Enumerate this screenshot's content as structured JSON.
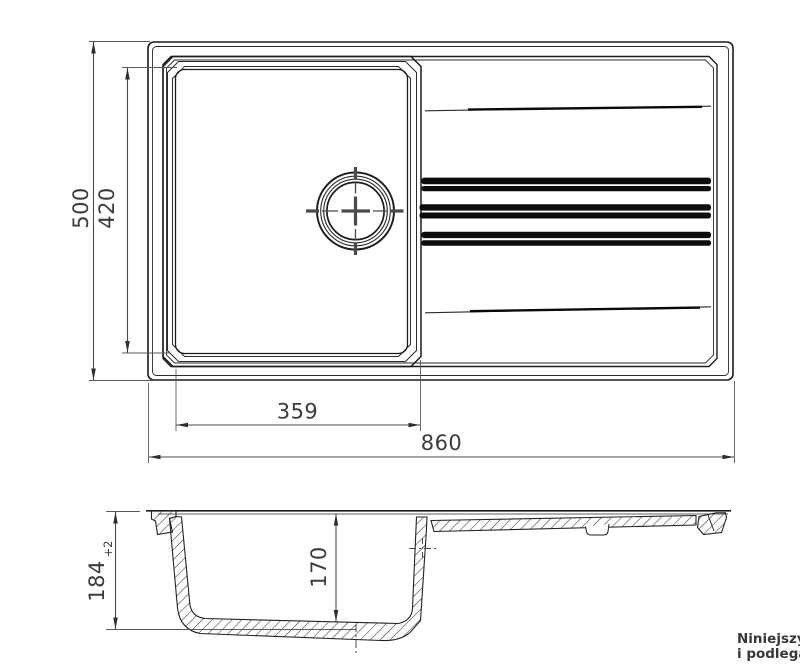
{
  "drawing": {
    "plan_view": {
      "overall_width": "860",
      "overall_depth": "500",
      "bowl_width": "359",
      "bowl_depth": "420"
    },
    "section_view": {
      "overall_height": "184",
      "height_tolerance": "+2",
      "bowl_inner_depth": "170"
    },
    "footer_note": {
      "line1": "Niniejszy",
      "line2": "i podlega"
    },
    "colors": {
      "line": "#1c1c1c",
      "dimension_text": "#3c3c3c",
      "background": "#ffffff"
    }
  }
}
